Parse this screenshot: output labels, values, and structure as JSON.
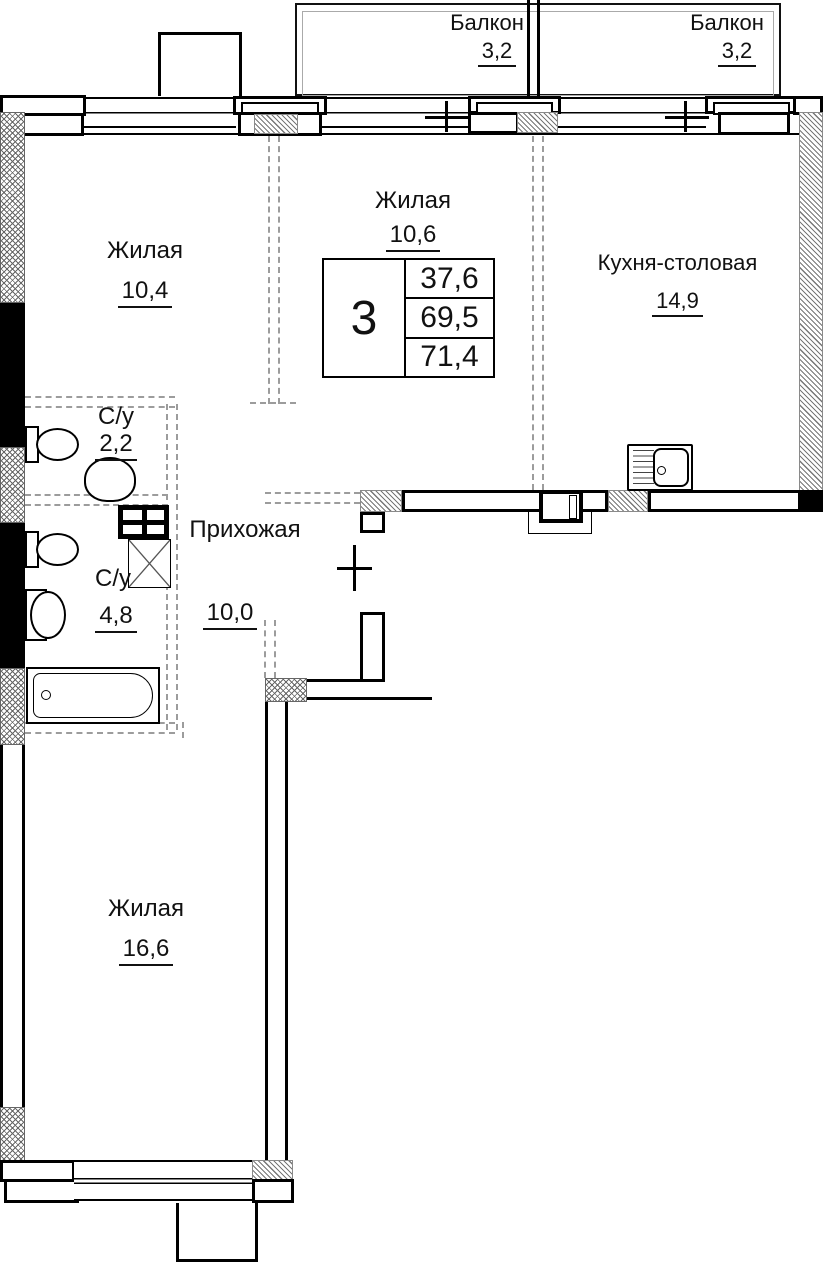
{
  "summary": {
    "rooms_count": "3",
    "living_area": "37,6",
    "area": "69,5",
    "total_area": "71,4"
  },
  "balconies": [
    {
      "label": "Балкон",
      "area": "3,2"
    },
    {
      "label": "Балкон",
      "area": "3,2"
    }
  ],
  "rooms": [
    {
      "name": "Жилая",
      "area": "10,4"
    },
    {
      "name": "Жилая",
      "area": "10,6"
    },
    {
      "name": "Кухня-столовая",
      "area": "14,9"
    },
    {
      "name": "С/у",
      "area": "2,2"
    },
    {
      "name": "С/у",
      "area": "4,8"
    },
    {
      "name": "Прихожая",
      "area": "10,0"
    },
    {
      "name": "Жилая",
      "area": "16,6"
    }
  ],
  "fixtures": [
    "toilet",
    "toilet",
    "washbasin",
    "washbasin",
    "bathtub",
    "kitchen-sink",
    "vent-shaft-grid",
    "shaft-x-box",
    "duct-box"
  ],
  "colors": {
    "wall": "#000000",
    "partition_dashed": "#9c9c9c",
    "hatch": "#777777",
    "background": "#ffffff",
    "text": "#111111"
  }
}
